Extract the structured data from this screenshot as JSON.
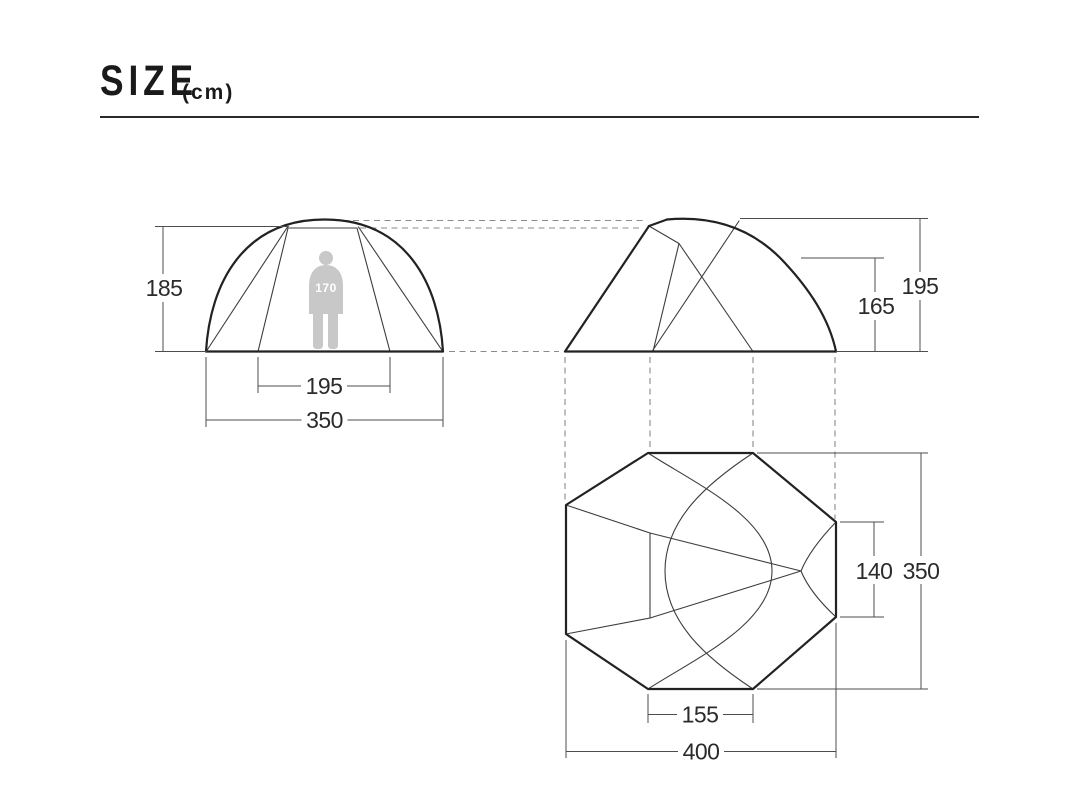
{
  "header": {
    "title": "SIZE",
    "unit": "(cm)"
  },
  "views": {
    "front": {
      "height_label": "185",
      "inner_width_label": "195",
      "outer_width_label": "350",
      "person_height_label": "170"
    },
    "side": {
      "inner_height_label": "165",
      "total_height_label": "195"
    },
    "top": {
      "inner_depth_label": "140",
      "total_depth_label": "350",
      "door_width_label": "155",
      "total_width_label": "400"
    }
  },
  "colors": {
    "outline": "#222222",
    "dimension_line": "#4d4d4d",
    "dashed_line": "#8a8a8a",
    "silhouette": "#c8c8c8",
    "person_text": "#ffffff"
  }
}
